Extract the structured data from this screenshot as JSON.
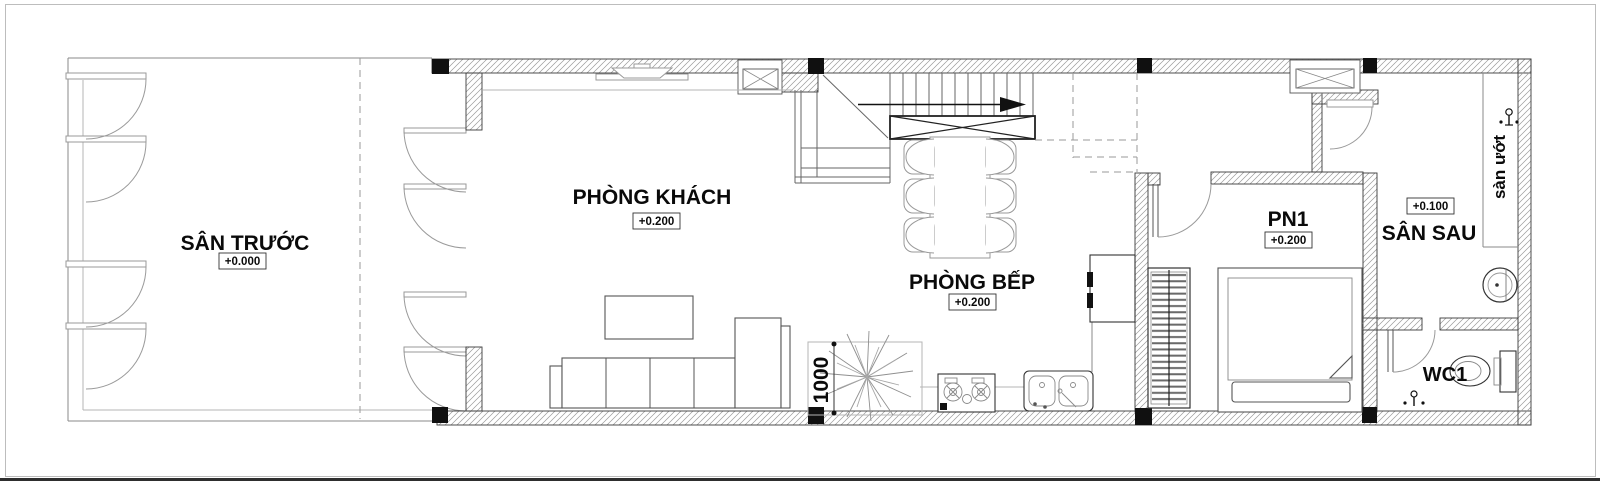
{
  "rooms": {
    "front_yard": {
      "label": "SÂN TRƯỚC",
      "level": "+0.000"
    },
    "living_room": {
      "label": "PHÒNG KHÁCH",
      "level": "+0.200"
    },
    "kitchen": {
      "label": "PHÒNG BẾP",
      "level": "+0.200"
    },
    "bedroom_1": {
      "label": "PN1",
      "level": "+0.200"
    },
    "back_yard": {
      "label": "SÂN SAU",
      "level": "+0.100"
    },
    "wc_1": {
      "label": "WC1"
    },
    "wet_floor": {
      "label": "sàn ướt"
    }
  },
  "dimensions": {
    "planter_width": "1000"
  },
  "colors": {
    "wall_line": "#3a3a3a",
    "hatch": "#9a9a9a",
    "furniture": "#555555",
    "background": "#ffffff"
  }
}
